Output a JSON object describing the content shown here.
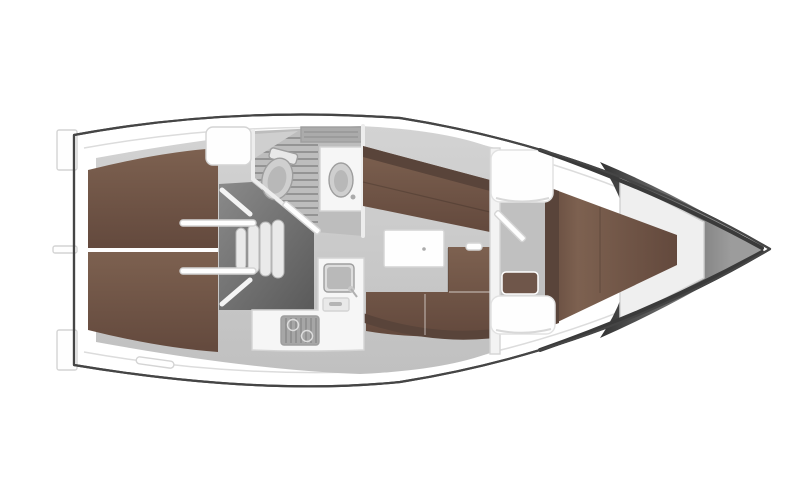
{
  "meta": {
    "type": "yacht-interior-floor-plan",
    "view": "top-down",
    "orientation": "bow-right-stern-left"
  },
  "colors": {
    "page_bg": "#ffffff",
    "hull_outline": "#454545",
    "deck_white": "#fcfcfc",
    "deck_trim": "#dcdcdc",
    "floor_light": "#d3d3d3",
    "floor_dark": "#c0c0c0",
    "head_floor": "#bdbdbd",
    "grate_line": "#949494",
    "berth_light": "#7d6150",
    "berth_dark": "#63493d",
    "berth_edge_dark": "#59443a",
    "settee_brown": "#76594a",
    "bench_brown": "#6f564a",
    "furniture_white": "#f6f6f6",
    "bright_white": "#fefefe",
    "bulkhead_white": "#f3f3f3",
    "fixture_gray": "#cfcfcf",
    "fixture_inner": "#b8b8b8",
    "cistern_white": "#e8e8e8",
    "cabinet_gray": "#ababab",
    "sink_rim": "#dddddd",
    "sink_inner": "#b9b9b9",
    "drawer_white": "#e9e9e9",
    "handle_gray": "#b5b5b5",
    "stove_gray": "#a6a6a6",
    "engine_light": "#8a8a8a",
    "engine_dark": "#5a5a5a",
    "step_white": "#eaeaea",
    "bow_dark": "#343434",
    "bow_light": "#9c9c9c",
    "frame_white": "#efefef",
    "knob_gray": "#c9c9c9"
  },
  "features": [
    {
      "id": "hull",
      "label": "hull outline"
    },
    {
      "id": "stern-platform",
      "label": "stern swim platform"
    },
    {
      "id": "aft-berth-port",
      "label": "aft cabin berth (port)"
    },
    {
      "id": "aft-berth-starboard",
      "label": "aft cabin berth (starboard)"
    },
    {
      "id": "engine-compartment",
      "label": "engine compartment"
    },
    {
      "id": "companionway-steps",
      "label": "companionway steps"
    },
    {
      "id": "companionway-hatch-seat",
      "label": "companionway hatch seat"
    },
    {
      "id": "head-shower",
      "label": "head with shower grating"
    },
    {
      "id": "toilet",
      "label": "toilet"
    },
    {
      "id": "head-sink",
      "label": "head washbasin"
    },
    {
      "id": "head-door",
      "label": "head door"
    },
    {
      "id": "port-settee",
      "label": "port settee"
    },
    {
      "id": "saloon-table",
      "label": "saloon table"
    },
    {
      "id": "starboard-settee",
      "label": "starboard L-settee"
    },
    {
      "id": "galley",
      "label": "galley counter"
    },
    {
      "id": "galley-sink",
      "label": "galley sink"
    },
    {
      "id": "stove",
      "label": "stove"
    },
    {
      "id": "forward-bulkhead",
      "label": "forward cabin bulkhead"
    },
    {
      "id": "forward-cabin-door",
      "label": "forward cabin door"
    },
    {
      "id": "bulkhead-seat-upper",
      "label": "locker seat upper"
    },
    {
      "id": "bulkhead-seat-lower",
      "label": "locker seat lower"
    },
    {
      "id": "forward-cabin-bench",
      "label": "forward cabin bench"
    },
    {
      "id": "v-berth",
      "label": "forward V-berth"
    },
    {
      "id": "bow",
      "label": "bow"
    }
  ]
}
